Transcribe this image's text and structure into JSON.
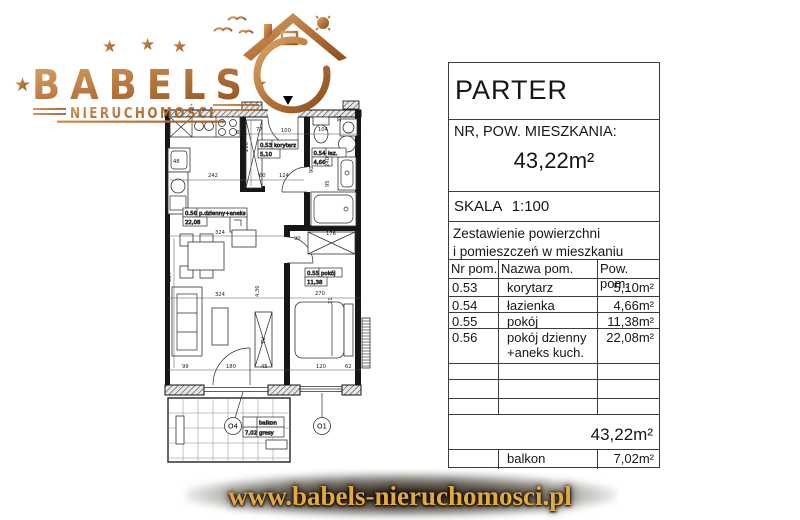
{
  "brand": {
    "name": "BABELS",
    "subtitle": "NIERUCHOMOŚCI",
    "star": "★",
    "gold_light": "#d9a668",
    "gold_dark": "#8d4e1d",
    "url_gold": "#e2a93d",
    "website": "www.babels-nieruchomosci.pl"
  },
  "info_panel": {
    "floor_label": "PARTER",
    "unit_label": "NR, POW. MIESZKANIA:",
    "unit_area": "43,22m²",
    "scale_label": "SKALA 1:100",
    "summary_title_line1": "Zestawienie powierzchni",
    "summary_title_line2": "i pomieszczeń w mieszkaniu",
    "columns": [
      "Nr pom.",
      "Nazwa pom.",
      "Pow. pom."
    ],
    "rows": [
      {
        "nr": "0.53",
        "name": "korytarz",
        "area": "5,10m²"
      },
      {
        "nr": "0.54",
        "name": "łazienka",
        "area": "4,66m²"
      },
      {
        "nr": "0.55",
        "name": "pokój",
        "area": "11,38m²"
      },
      {
        "nr": "0.56",
        "name": "pokój dzienny +aneks kuch.",
        "area": "22,08m²"
      }
    ],
    "total_area": "43,22m²",
    "balcony_row": {
      "nr": "",
      "name": "balkon",
      "area": "7,02m²"
    }
  },
  "plan": {
    "rooms": [
      {
        "nr": "0.53",
        "name": "korytarz",
        "area": "5,10"
      },
      {
        "nr": "0.54",
        "name": "łaz.",
        "area": "4,66"
      },
      {
        "nr": "0.55",
        "name": "pokój",
        "area": "11,38"
      },
      {
        "nr": "0.56",
        "name": "p.dzienny+aneks",
        "area": "22,08"
      }
    ],
    "balcony": {
      "name": "balkon",
      "area": "7,02",
      "finish": "gresy"
    },
    "marks": [
      "O4",
      "O1"
    ],
    "tv": "TV",
    "dims": [
      "242",
      "77",
      "100",
      "104",
      "60",
      "124",
      "90",
      "240",
      "95",
      "210",
      "324",
      "324",
      "534",
      "4,36",
      "270",
      "176",
      "90",
      "99",
      "180",
      "45",
      "88",
      "120",
      "62",
      "65",
      "48",
      "35",
      "21"
    ]
  }
}
